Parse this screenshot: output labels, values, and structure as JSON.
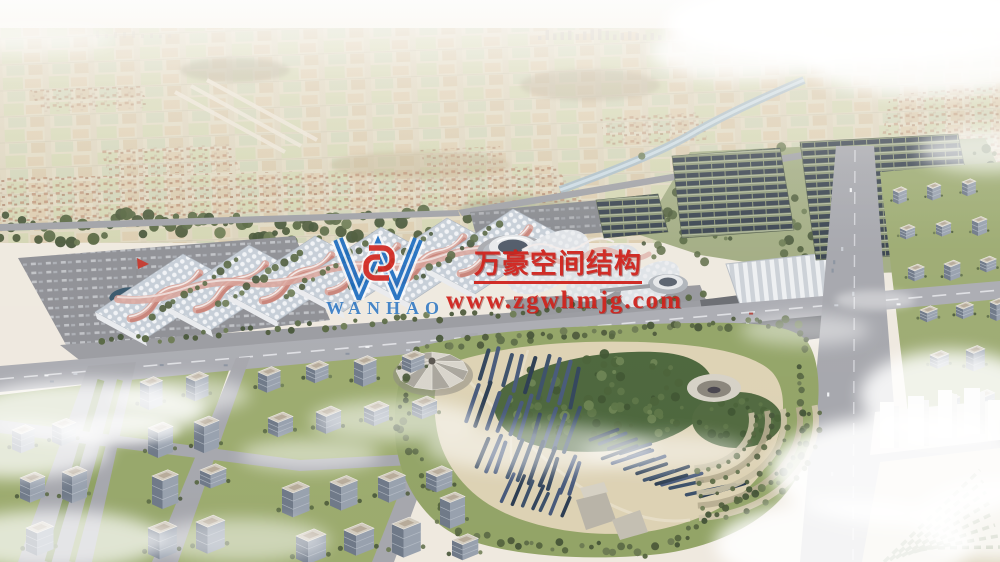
{
  "watermark": {
    "logo_text": "WANHAO",
    "company_name": "万豪空间结构",
    "website": "www.zgwhmjg.com",
    "text_color": "#cf231d",
    "logo_color": "#1b6cc0",
    "logo_emblem_color": "#d2251e"
  }
}
